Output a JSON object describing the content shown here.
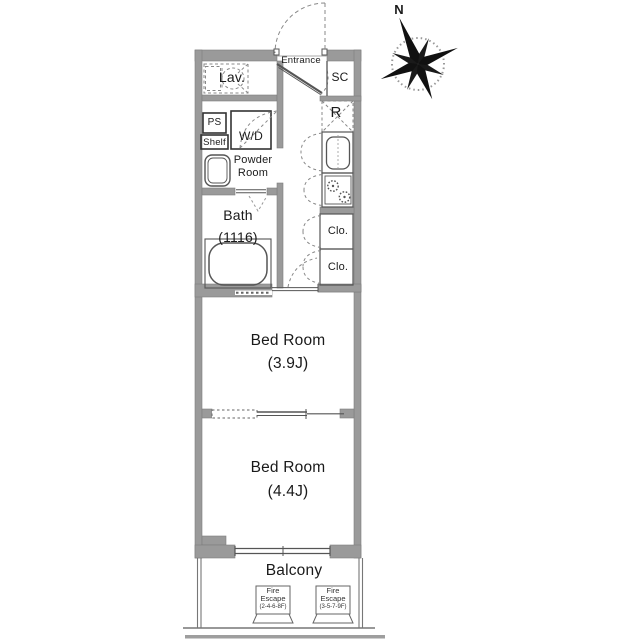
{
  "plan": {
    "compass": {
      "north": "N"
    },
    "rooms": {
      "entrance": {
        "label": "Entrance"
      },
      "lavatory": {
        "label": "Lav."
      },
      "shoe_closet": {
        "label": "SC"
      },
      "refrigerator": {
        "label": "R"
      },
      "pipe_space": {
        "label": "PS"
      },
      "shelf": {
        "label": "Shelf"
      },
      "washer_dryer": {
        "label": "W/D"
      },
      "powder_room": {
        "line1": "Powder",
        "line2": "Room"
      },
      "bath": {
        "line1": "Bath",
        "line2": "(1116)"
      },
      "closet_upper": {
        "label": "Clo."
      },
      "closet_lower": {
        "label": "Clo."
      },
      "bedroom_1": {
        "line1": "Bed Room",
        "line2": "(3.9J)"
      },
      "bedroom_2": {
        "line1": "Bed Room",
        "line2": "(4.4J)"
      },
      "balcony": {
        "label": "Balcony"
      }
    },
    "fire_escapes": {
      "left": {
        "line1": "Fire",
        "line2": "Escape",
        "line3": "(2-4-6-8F)"
      },
      "right": {
        "line1": "Fire",
        "line2": "Escape",
        "line3": "(3-5-7-9F)"
      }
    },
    "colors": {
      "wall": "#9a9a9a",
      "line": "#555555",
      "dash": "#888888",
      "text": "#1a1a1a",
      "ground": "#9e9e9e"
    }
  }
}
